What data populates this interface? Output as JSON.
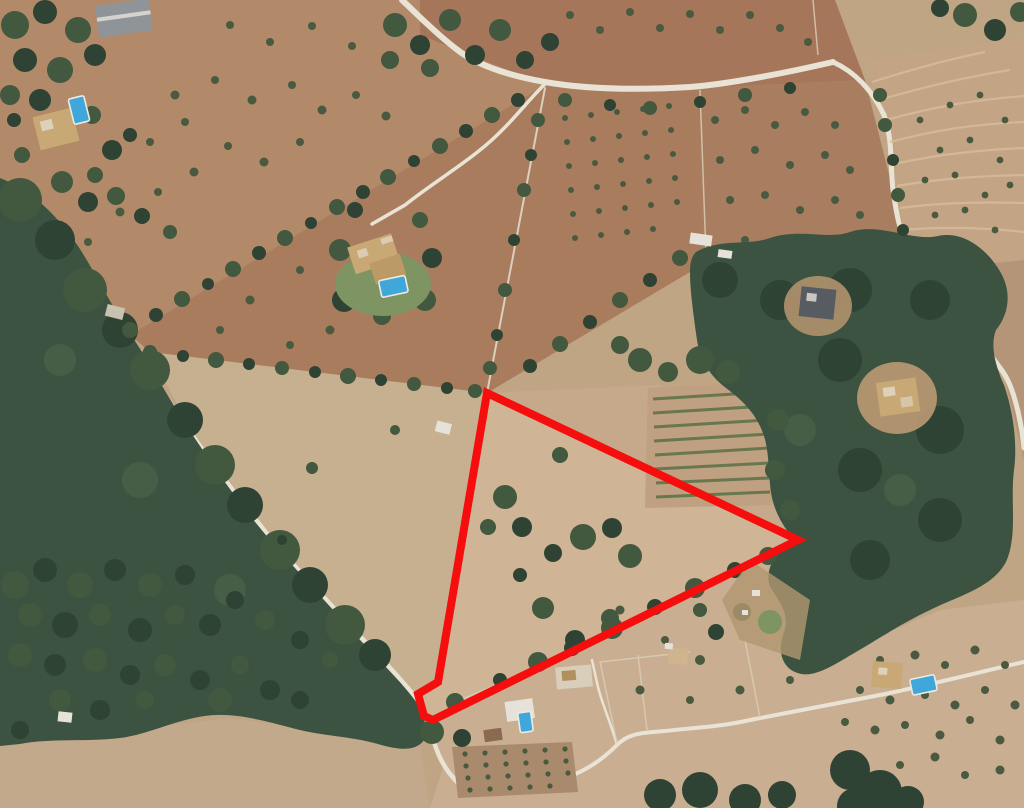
{
  "meta": {
    "type": "satellite-aerial-photograph",
    "subject": "aerial view of rural farmland with woodland, scattered villas with pools, winding lanes, and a land parcel outlined in red",
    "width": 1024,
    "height": 808
  },
  "annotation": {
    "name": "property-boundary",
    "shape": "polygon",
    "points": "487,393 438,682 418,694 424,716 433,720 798,540",
    "color": "#f60d0d",
    "stroke_width": 8
  },
  "colors": {
    "red": "#f60d0d",
    "base": "#c0a585",
    "field_tl": "#b28a69",
    "field_mid": "#aa7c5e",
    "field_top": "#a5765a",
    "field_right": "#a97d60",
    "orchard_tr": "#c3a484",
    "stripe": "#d6bc9b",
    "far_right": "#b59577",
    "pasture": "#c6b08f",
    "triangle_field": "#d0b496",
    "ne_strip": "#c6a98a",
    "bottom_field": "#c9ae92",
    "bottom_left_field": "#c3a98b",
    "orchard_patch": "#a98a6d",
    "vine_patch": "#bfa080",
    "vine_row": "#5f7349",
    "forest": "#3b5340",
    "forest_dark": "#2e4334",
    "tree": "#42583f",
    "tree_light": "#52684c",
    "lawn": "#7e9463",
    "road": "#e9e3d6",
    "pool": "#3fa7d9",
    "roof_tan": "#c8a874",
    "roof_gray": "#8f9499",
    "roof_dark": "#575c63",
    "roof_brown": "#8a6a50",
    "white_bldg": "#e6e2da",
    "fence": "#dccfb8",
    "dot": "#4a5a40"
  }
}
